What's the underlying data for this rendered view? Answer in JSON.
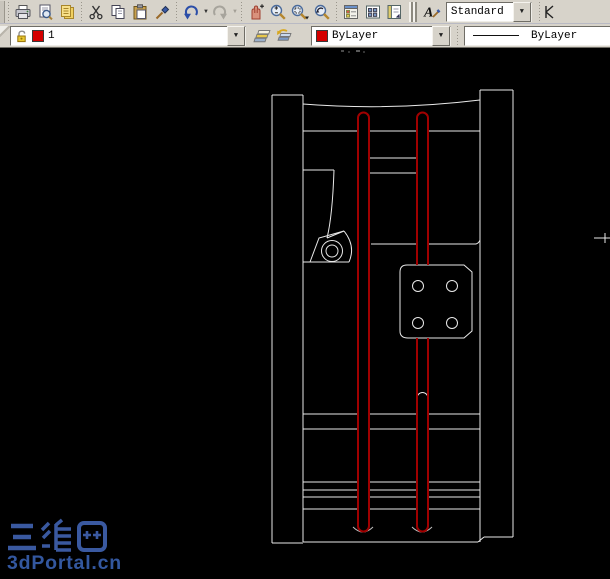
{
  "top_toolbar": {
    "icons": [
      "plot-icon",
      "plot-preview-icon",
      "publish-icon",
      "cut-icon",
      "copy-icon",
      "paste-icon",
      "match-properties-icon",
      "undo-icon",
      "redo-icon",
      "pan-icon",
      "zoom-realtime-icon",
      "zoom-window-icon",
      "zoom-previous-icon",
      "properties-icon",
      "design-center-icon",
      "tool-palettes-icon",
      "text-style-icon"
    ],
    "style_dropdown": {
      "value": "Standard"
    }
  },
  "layer_toolbar": {
    "layer_dropdown": {
      "value": "1",
      "swatch_color": "#d40000",
      "state_icon": "unlock-icon"
    },
    "buttons": [
      "layer-properties-icon",
      "layer-previous-icon"
    ],
    "color_dropdown": {
      "value": "ByLayer",
      "swatch_color": "#d40000"
    },
    "linetype_dropdown": {
      "value": "ByLayer"
    }
  },
  "glyphs": {
    "caret": "▼",
    "text_style_letter": "A"
  },
  "canvas": {
    "background": "#000000",
    "geometry_color": "#e9e9e9",
    "highlight_color": "#a00000"
  },
  "watermark": {
    "title": "三维网",
    "subtitle": "3dPortal.cn",
    "color": "#3a59a0"
  }
}
